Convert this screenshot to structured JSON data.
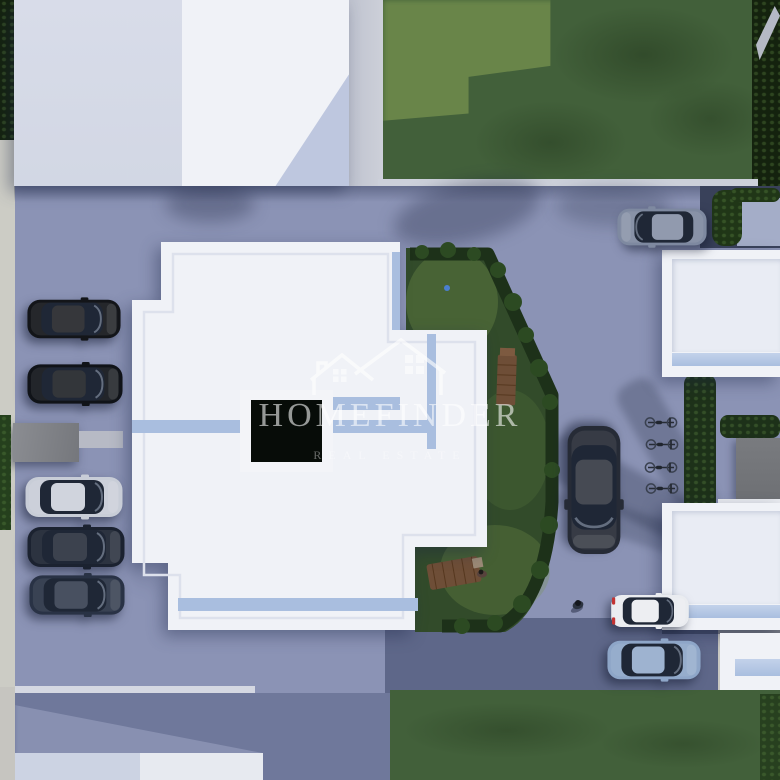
{
  "watermark": {
    "brand": "HOMEFINDER",
    "tagline": "REAL ESTATE",
    "logo_icon": "homefinder-double-house-icon",
    "color": "#ffffff"
  },
  "scene": {
    "description": "Aerial top-down 3D architectural render of a residential complex: white flat-roof buildings, paved courtyard, parked cars, bicycle rack, hedged gardens with picnic tables, lawns and an access road",
    "inventory": {
      "buildings": 6,
      "parked_cars": 9,
      "bicycles": 4,
      "pedestrians": 2,
      "picnic_tables": 2,
      "gardens": 2
    },
    "colors": {
      "pavement": "#8b93b5",
      "pavementLight": "#9aa2c1",
      "roadDark": "#5e6789",
      "roadMid": "#6f789b",
      "grassField": "#42603a",
      "grassLight": "#8aa457",
      "gardenGrass": "#324b2a",
      "hedge": "#1d3119",
      "treeDark": "#14220e",
      "roofWhite": "#f0f2f7",
      "roofGray": "#d8dce9",
      "roofShade": "#b8c2db",
      "glassBlue": "#a9bedf",
      "sidewalk": "#ccccc5",
      "shedGray": "#85878c",
      "garageGray": "#6e7074",
      "woodBrown": "#6e4e37",
      "carBlack": "#131519",
      "carNavy": "#1b2230",
      "carSilver": "#c8cdd7",
      "carSteel": "#293245",
      "carSuv": "#7e89a0",
      "carWhite": "#eaecf0",
      "carBlue": "#8ea6c8"
    }
  }
}
